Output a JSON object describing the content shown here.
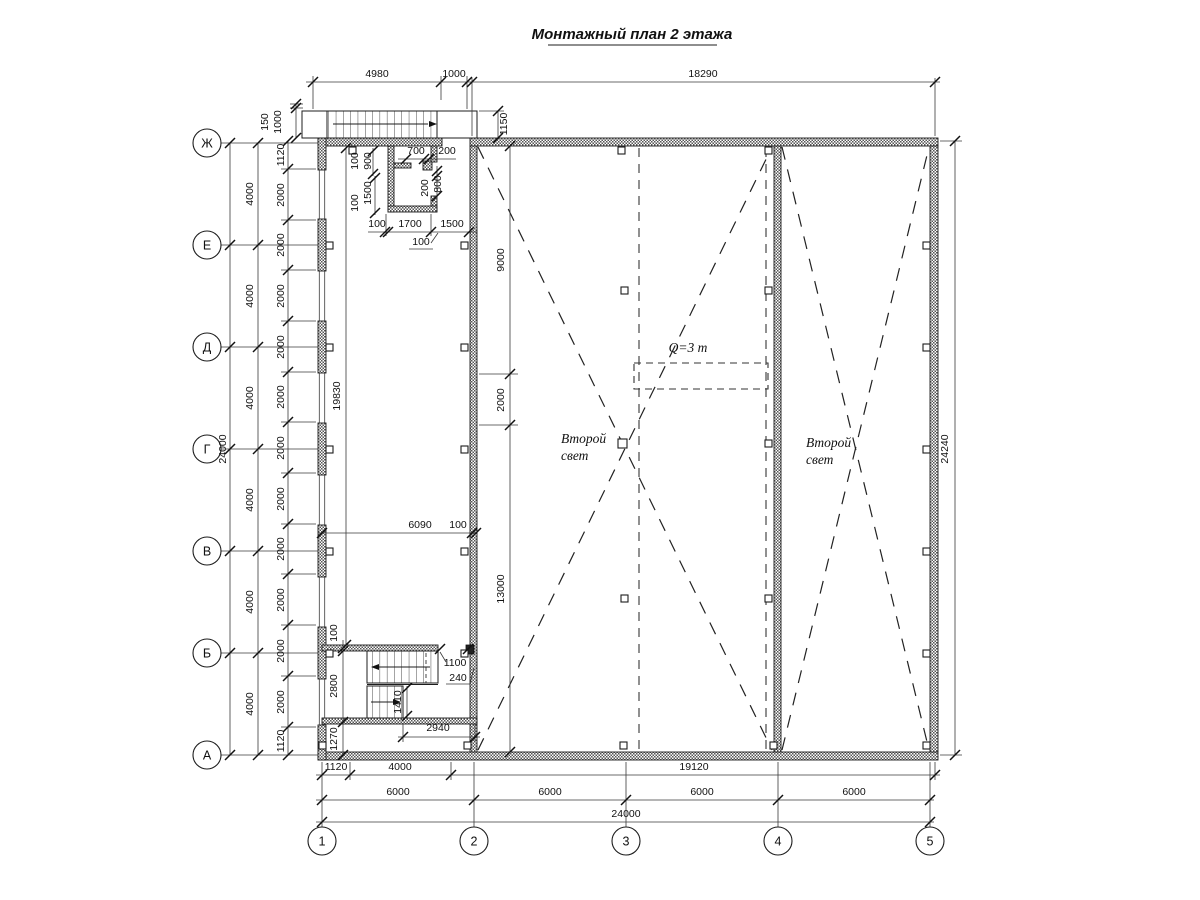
{
  "title": {
    "text": "Монтажный план 2 этажа"
  },
  "grid": {
    "rows": [
      "Ж",
      "Е",
      "Д",
      "Г",
      "В",
      "Б",
      "А"
    ],
    "cols": [
      "1",
      "2",
      "3",
      "4",
      "5"
    ]
  },
  "dims": {
    "top": {
      "a": "4980",
      "b": "1000",
      "c": "18290"
    },
    "right": {
      "a": "24240"
    },
    "left": {
      "total": "24000",
      "bays": [
        "4000",
        "4000",
        "4000",
        "4000",
        "4000",
        "4000"
      ],
      "chain": [
        "1120",
        "2000",
        "2000",
        "2000",
        "2000",
        "2000",
        "2000",
        "2000",
        "2000",
        "2000",
        "2000",
        "2000",
        "1120"
      ],
      "p150": "150",
      "p1000": "1000"
    },
    "bottom": {
      "r1": [
        "1120",
        "4000",
        "19120"
      ],
      "r2": [
        "6000",
        "6000",
        "6000",
        "6000"
      ],
      "total": "24000"
    },
    "hall": {
      "a": "1150",
      "b": "9000",
      "c": "2000",
      "d": "13000"
    },
    "strip": {
      "a": "19830",
      "b": "6090",
      "c": "100"
    },
    "room": {
      "a": "100",
      "b": "900",
      "c": "1500",
      "d": "100",
      "e": "700",
      "f": "200",
      "g": "200",
      "h": "800",
      "i": "100",
      "j": "1700",
      "k": "1500",
      "l": "100"
    },
    "stair": {
      "a": "100",
      "b": "2800",
      "c": "1270",
      "d": "1100",
      "e": "240",
      "f": "1410",
      "g": "2940"
    }
  },
  "labels": {
    "crane": "Q=3 т",
    "sl1": "Второй",
    "sl2": "свет"
  },
  "colors": {
    "line": "#1a1a1a",
    "hatch": "#555",
    "bg": "#ffffff"
  }
}
